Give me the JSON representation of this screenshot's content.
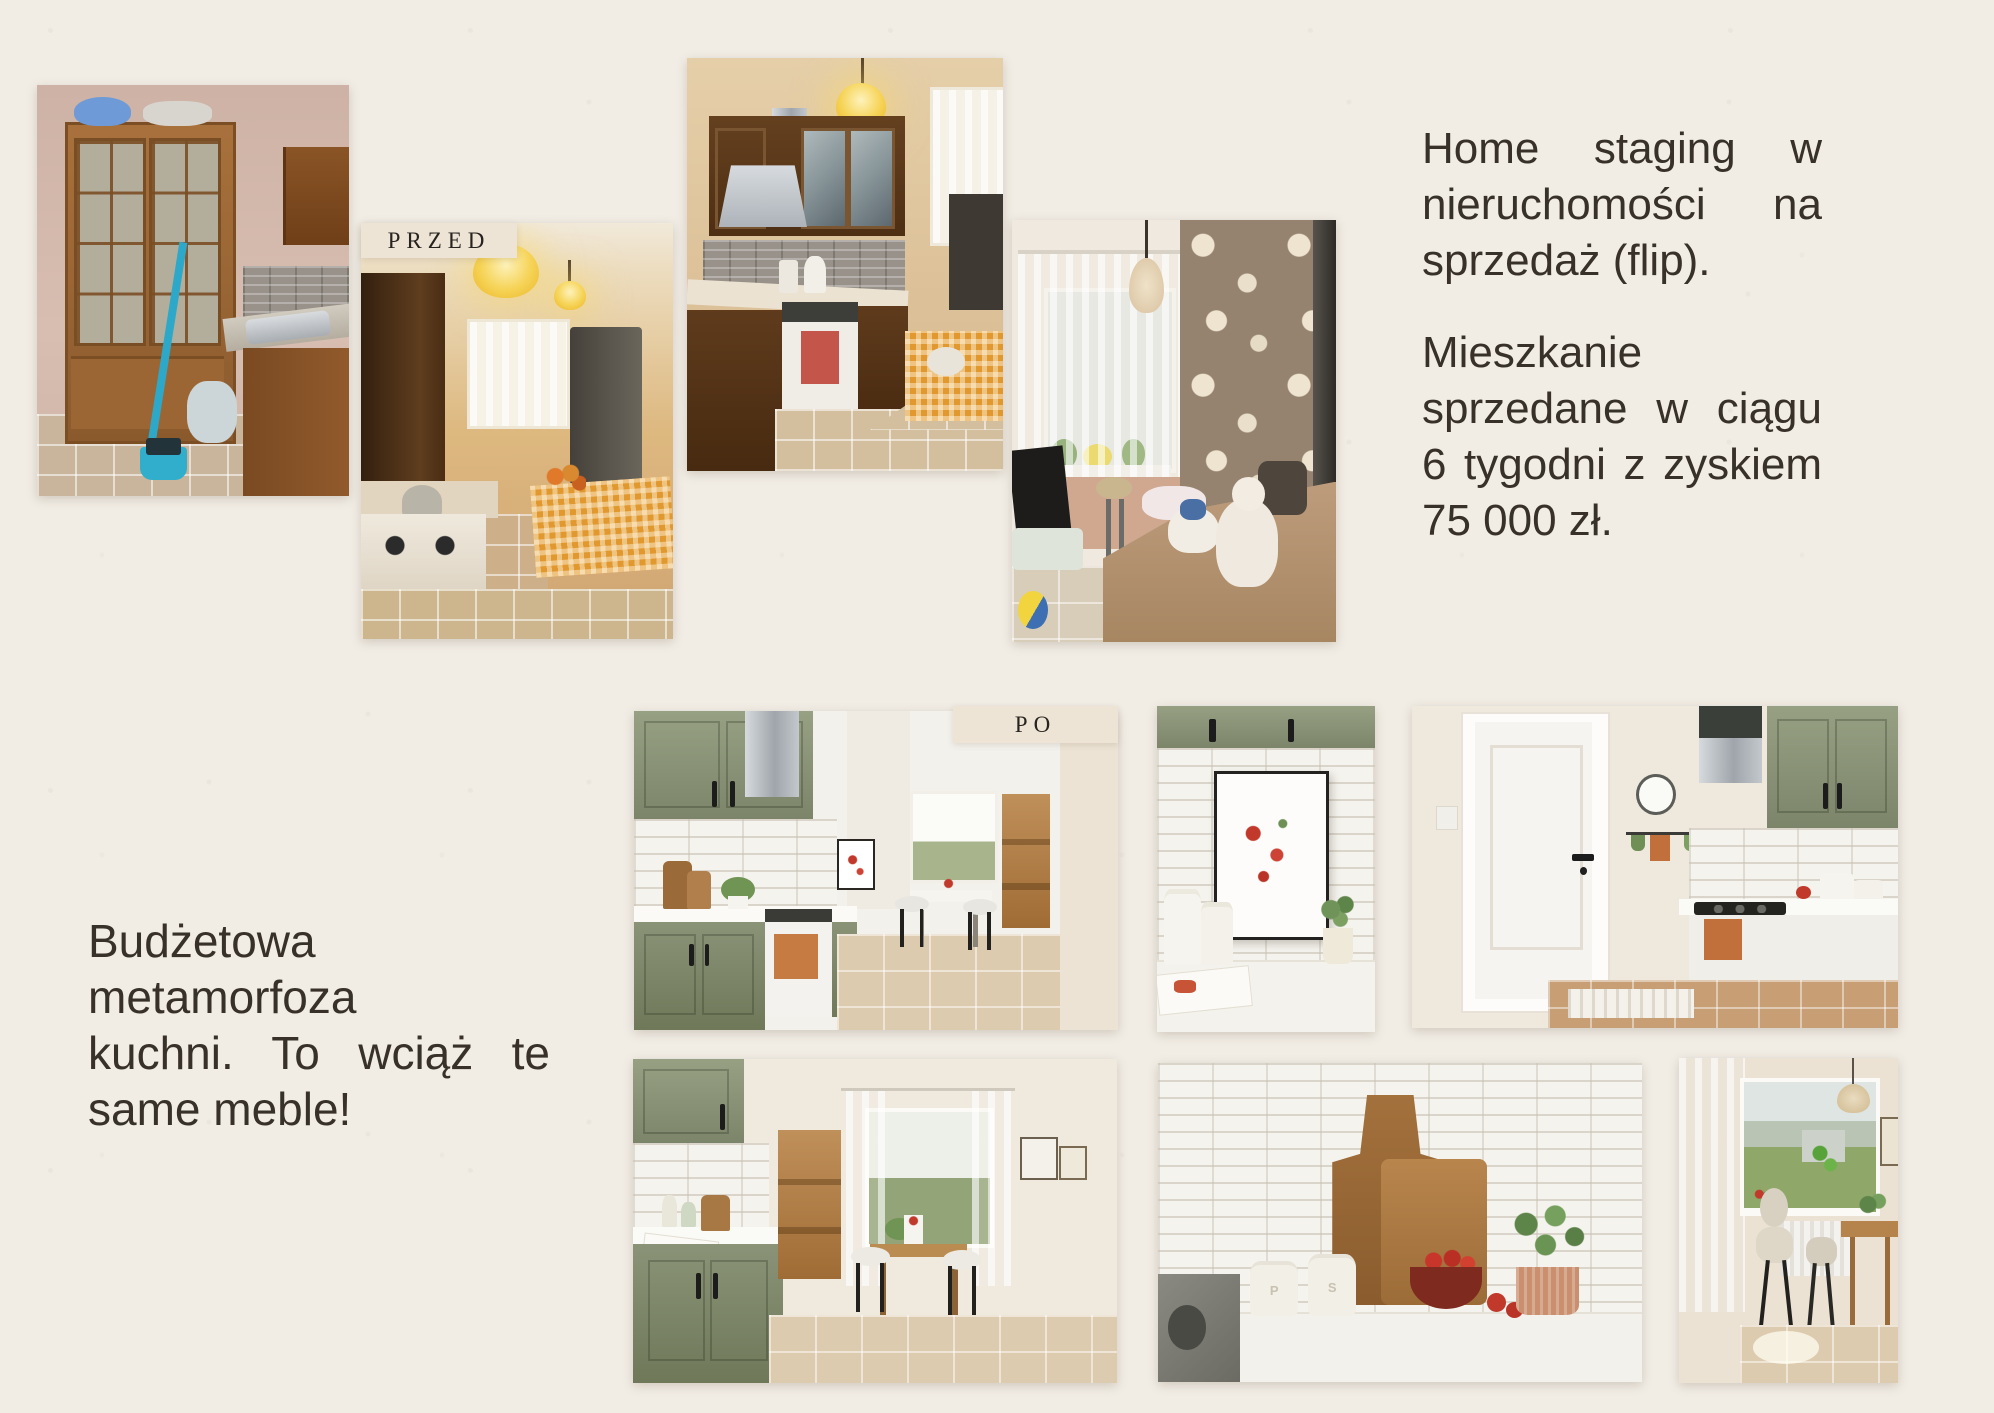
{
  "page": {
    "background": "#f1ede5",
    "text_color": "#38312a",
    "label_background": "#eee4d6"
  },
  "labels": {
    "before": "PRZED",
    "after": "PO"
  },
  "right_text": {
    "full": "Home staging w nieruchomości na sprzedaż (flip). Mieszkanie sprzedane w ciągu 6 tygodni z zyskiem 75 000 zł.",
    "p1_lines": [
      "Home staging w",
      "nieruchomości na",
      "sprzedaż (flip)."
    ],
    "p2_lines": [
      "Mieszkanie",
      "sprzedane w ciągu",
      "6 tygodni z zyskiem",
      "75 000 zł."
    ]
  },
  "left_text": {
    "full": "Budżetowa metamorfoza kuchni. To wciąż te same meble!",
    "lines": [
      "Budżetowa",
      "metamorfoza",
      "kuchni. To wciąż te",
      "same meble!"
    ]
  },
  "photo_details": {
    "shaker_left": "P",
    "shaker_right": "S"
  },
  "photos": {
    "before": [
      {
        "id": "before-kitchen-cabinet",
        "desc": "cluttered kitchen with pine china cabinet, sink and blue broom"
      },
      {
        "id": "before-kitchen-lamps",
        "desc": "dim kitchen with yellow pendant lamps and checkered table"
      },
      {
        "id": "before-kitchen-stove",
        "desc": "kitchen with dark brown cabinets, gas stove and steel hood"
      },
      {
        "id": "before-room-floral",
        "desc": "small room with floral wallpaper, bed and plush toys"
      }
    ],
    "after": [
      {
        "id": "after-kitchen-main",
        "desc": "bright kitchen with sage green cabinets and dining nook"
      },
      {
        "id": "after-tomato-art",
        "desc": "styled counter with framed tomato print and canisters"
      },
      {
        "id": "after-kitchen-door",
        "desc": "bright kitchen with white door, wall clock and sage cabinets"
      },
      {
        "id": "after-kitchen-window",
        "desc": "kitchen with window nook, wooden cabinet and chairs"
      },
      {
        "id": "after-cutting-boards",
        "desc": "counter with wooden boards, P and S shakers and tomatoes"
      },
      {
        "id": "after-dining-nook",
        "desc": "dining nook with window view, table, chairs and radiator"
      }
    ]
  }
}
